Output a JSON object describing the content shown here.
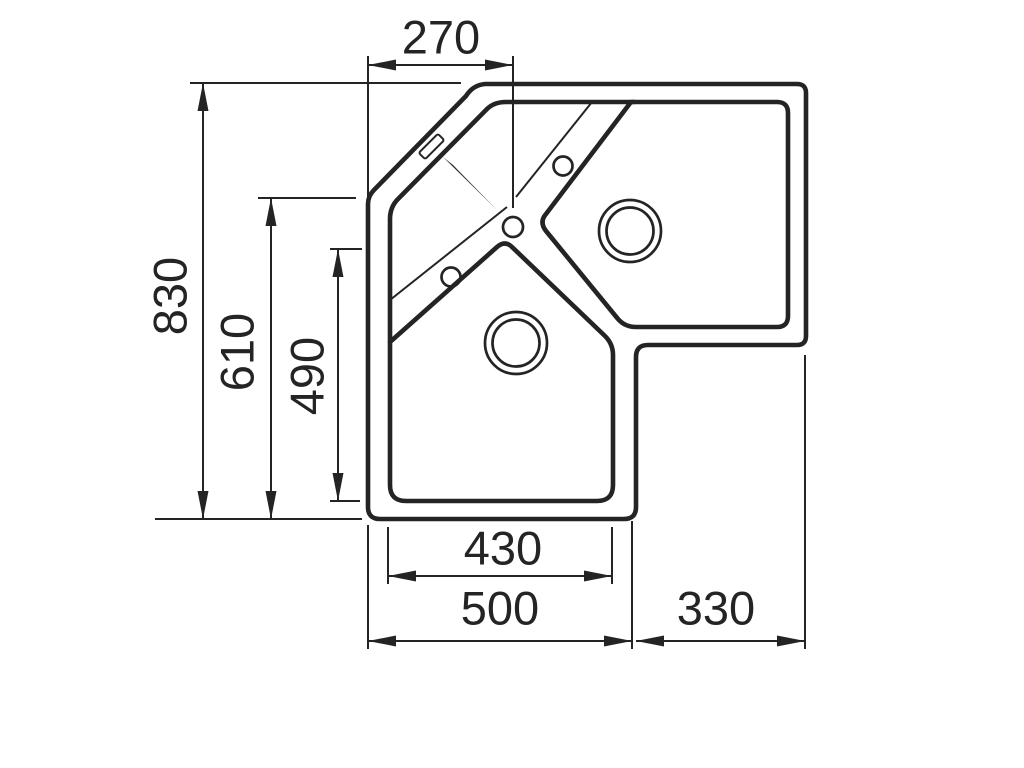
{
  "page": {
    "background": "#ffffff",
    "line_color": "#242424"
  },
  "diagram": {
    "type": "technical-drawing",
    "subject": "Corner kitchen sink - top view with dimensions",
    "units": "mm",
    "labels": {
      "overall_depth": "830",
      "left_edge_depth": "610",
      "lower_bowl_inner_depth": "490",
      "left_edge_to_faucet": "270",
      "lower_bowl_inner_width": "430",
      "lower_section_width": "500",
      "right_section_width": "330"
    }
  }
}
